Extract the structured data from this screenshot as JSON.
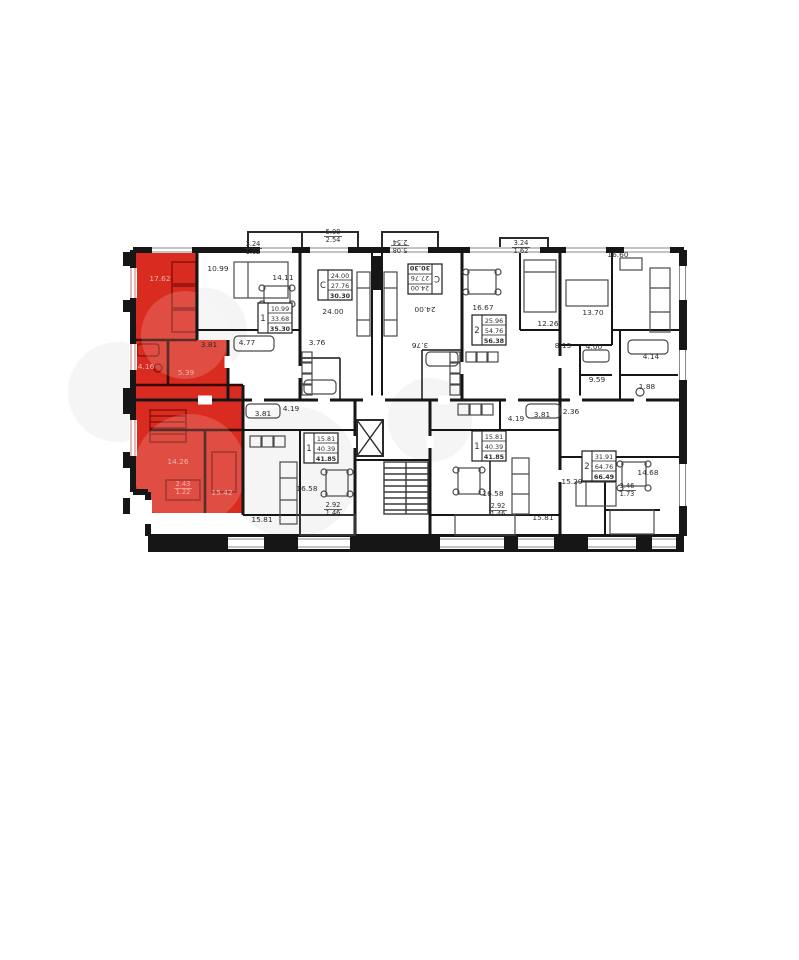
{
  "image_title": "Floor plan with highlighted apartment",
  "colors": {
    "wall": "#161616",
    "partition": "#2b2b2b",
    "furniture": "#4a4a4a",
    "highlight": "#d92b1f",
    "highlight_dark": "#8f130c",
    "highlight_text": "#f2b3ab",
    "label_text": "#2d2d2d",
    "box_border": "#1c1c1c",
    "watermark": "#f4f4f4"
  },
  "floor_plan": {
    "room_labels": [
      {
        "x": 253,
        "y": 246,
        "lines": [
          "3.24",
          "1.62"
        ]
      },
      {
        "x": 333,
        "y": 234,
        "lines": [
          "5.08",
          "2.54"
        ]
      },
      {
        "x": 400,
        "y": 248,
        "lines": [
          "5.08",
          "2.54"
        ],
        "rot": 180
      },
      {
        "x": 521,
        "y": 245,
        "lines": [
          "3.24",
          "1.62"
        ]
      },
      {
        "x": 618,
        "y": 257,
        "lines": [
          "16.60"
        ]
      },
      {
        "x": 218,
        "y": 271,
        "lines": [
          "10.99"
        ]
      },
      {
        "x": 160,
        "y": 281,
        "lines": [
          "17.62"
        ],
        "red": true
      },
      {
        "x": 283,
        "y": 280,
        "lines": [
          "14.11"
        ]
      },
      {
        "x": 333,
        "y": 314,
        "lines": [
          "24.00"
        ]
      },
      {
        "x": 425,
        "y": 307,
        "lines": [
          "24.00"
        ],
        "rot": 180
      },
      {
        "x": 483,
        "y": 310,
        "lines": [
          "16.67"
        ]
      },
      {
        "x": 548,
        "y": 326,
        "lines": [
          "12.26"
        ]
      },
      {
        "x": 593,
        "y": 315,
        "lines": [
          "13.70"
        ]
      },
      {
        "x": 209,
        "y": 347,
        "lines": [
          "3.81"
        ]
      },
      {
        "x": 247,
        "y": 345,
        "lines": [
          "4.77"
        ]
      },
      {
        "x": 317,
        "y": 345,
        "lines": [
          "3.76"
        ]
      },
      {
        "x": 420,
        "y": 343,
        "lines": [
          "3.76"
        ],
        "rot": 180
      },
      {
        "x": 563,
        "y": 348,
        "lines": [
          "8.13"
        ]
      },
      {
        "x": 594,
        "y": 349,
        "lines": [
          "4.00"
        ]
      },
      {
        "x": 146,
        "y": 369,
        "lines": [
          "4.16"
        ],
        "red": true
      },
      {
        "x": 186,
        "y": 375,
        "lines": [
          "5.39"
        ],
        "red": true
      },
      {
        "x": 651,
        "y": 359,
        "lines": [
          "4.14"
        ]
      },
      {
        "x": 597,
        "y": 382,
        "lines": [
          "9.59"
        ]
      },
      {
        "x": 647,
        "y": 389,
        "lines": [
          "1.88"
        ]
      },
      {
        "x": 263,
        "y": 416,
        "lines": [
          "3.81"
        ]
      },
      {
        "x": 291,
        "y": 411,
        "lines": [
          "4.19"
        ]
      },
      {
        "x": 516,
        "y": 421,
        "lines": [
          "4.19"
        ]
      },
      {
        "x": 542,
        "y": 417,
        "lines": [
          "3.81"
        ]
      },
      {
        "x": 571,
        "y": 414,
        "lines": [
          "2.36"
        ]
      },
      {
        "x": 178,
        "y": 464,
        "lines": [
          "14.26"
        ],
        "red": true
      },
      {
        "x": 648,
        "y": 475,
        "lines": [
          "14.68"
        ]
      },
      {
        "x": 572,
        "y": 484,
        "lines": [
          "15.29"
        ]
      },
      {
        "x": 307,
        "y": 491,
        "lines": [
          "16.58"
        ]
      },
      {
        "x": 493,
        "y": 496,
        "lines": [
          "16.58"
        ]
      },
      {
        "x": 222,
        "y": 495,
        "lines": [
          "15.42"
        ],
        "red": true
      },
      {
        "x": 183,
        "y": 486,
        "lines": [
          "2.43",
          "1.22"
        ],
        "red": true
      },
      {
        "x": 627,
        "y": 488,
        "lines": [
          "3.46",
          "1.73"
        ]
      },
      {
        "x": 333,
        "y": 507,
        "lines": [
          "2.92",
          "1.46"
        ]
      },
      {
        "x": 498,
        "y": 508,
        "lines": [
          "2.92",
          "1.46"
        ]
      },
      {
        "x": 262,
        "y": 522,
        "lines": [
          "15.81"
        ]
      },
      {
        "x": 543,
        "y": 520,
        "lines": [
          "15.81"
        ]
      }
    ],
    "unit_boxes": [
      {
        "x": 318,
        "y": 270,
        "rooms": "С",
        "values": [
          "24.00",
          "27.76",
          "30.30"
        ]
      },
      {
        "x": 408,
        "y": 264,
        "rooms": "С",
        "values": [
          "24.00",
          "27.76",
          "30.30"
        ],
        "rot": 180
      },
      {
        "x": 258,
        "y": 303,
        "rooms": "1",
        "values": [
          "10.99",
          "33.68",
          "35.30"
        ]
      },
      {
        "x": 472,
        "y": 315,
        "rooms": "2",
        "values": [
          "25.96",
          "54.76",
          "56.38"
        ]
      },
      {
        "x": 304,
        "y": 433,
        "rooms": "1",
        "values": [
          "15.81",
          "40.39",
          "41.85"
        ]
      },
      {
        "x": 472,
        "y": 431,
        "rooms": "1",
        "values": [
          "15.81",
          "40.39",
          "41.85"
        ]
      },
      {
        "x": 582,
        "y": 451,
        "rooms": "2",
        "values": [
          "31.91",
          "64.76",
          "66.49"
        ]
      }
    ]
  }
}
